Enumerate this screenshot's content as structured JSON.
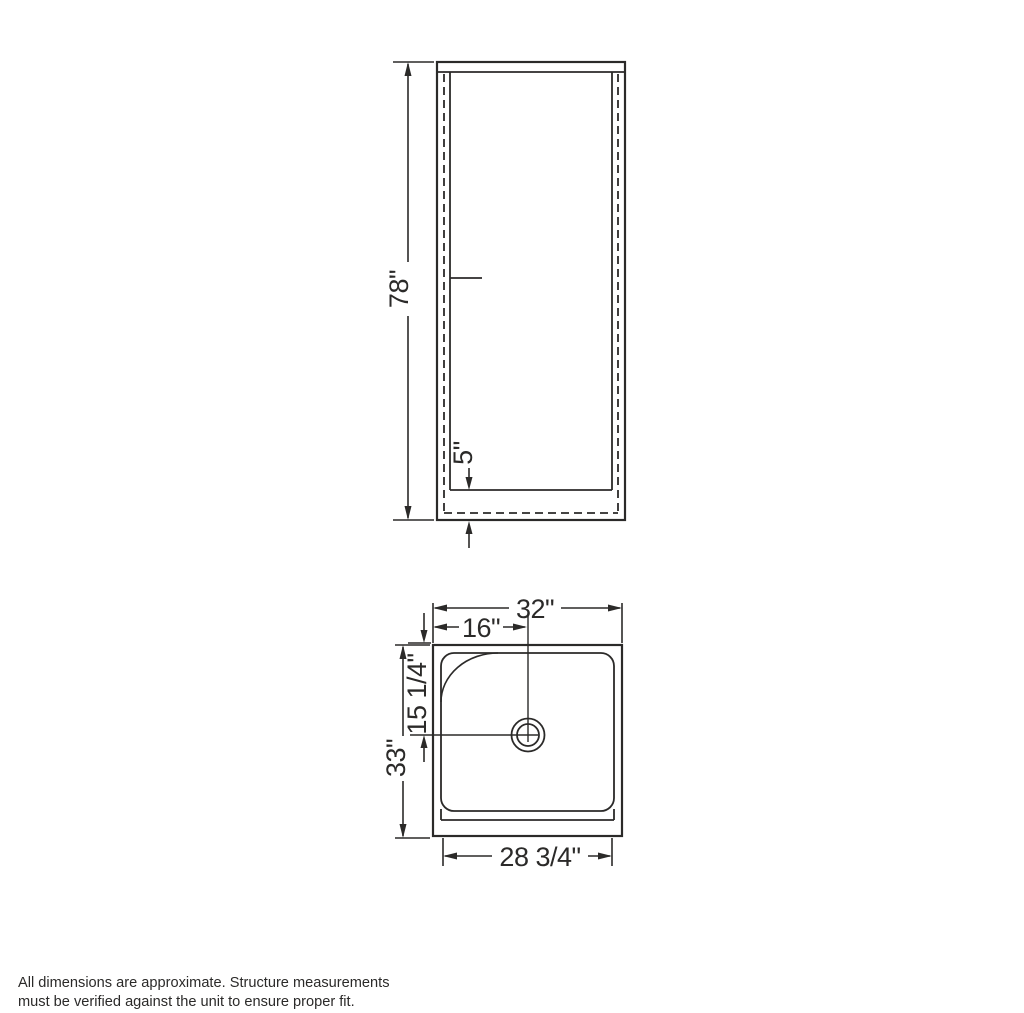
{
  "drawing": {
    "title": "Shower unit dimensional drawing",
    "front_view": {
      "height_label": "78\"",
      "threshold_height_label": "5\""
    },
    "plan_view": {
      "width_label": "32\"",
      "drain_offset_x_label": "16\"",
      "drain_offset_y_label": "15 1/4\"",
      "depth_label": "33\"",
      "base_width_label": "28 3/4\""
    },
    "footnote": {
      "line1": "All dimensions are approximate. Structure measurements",
      "line2": "must be verified against the unit to ensure proper fit."
    },
    "colors": {
      "line": "#2b2a29",
      "background": "#ffffff"
    }
  }
}
